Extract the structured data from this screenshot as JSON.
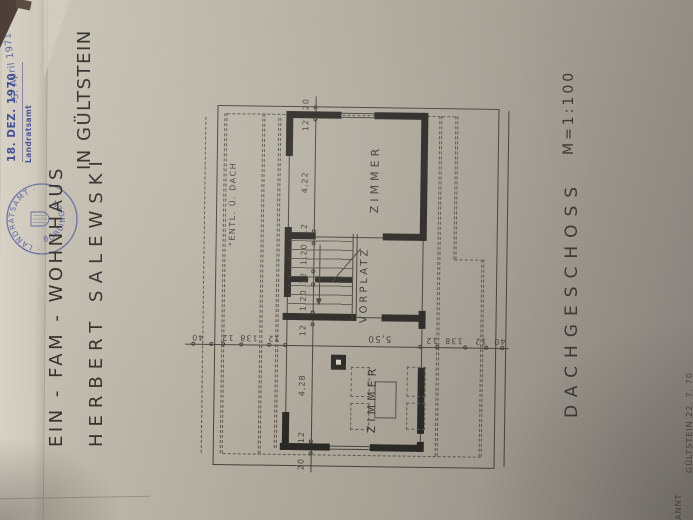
{
  "stamps": {
    "received_date": "18. DEZ. 1970",
    "received_office": "Landratsamt",
    "approval_date": "-5. April 1971",
    "seal_top": "· LANDRATSAMT ·",
    "seal_bottom": "BÖBLINGEN"
  },
  "title": {
    "line1": "EIN - FAM - WOHNHAUS",
    "line1b": "IN GÜLTSTEIN",
    "line2": "HERBERT SALEWSKI"
  },
  "drawing": {
    "name": "DACHGESCHOSS",
    "scale": "M=1:100",
    "rooms": {
      "room_top": "ZIMMER",
      "hall": "VORPLATZ",
      "room_bottom": "ZIMMER",
      "vent": "°ENTL. Ü. DACH",
      "room_width": "5,50"
    },
    "dims_depth": [
      "20",
      "12",
      "4,22",
      "12",
      "1,20",
      "12",
      "1,20",
      "12",
      "4,28",
      "12",
      "20"
    ],
    "dims_width_left": [
      "40",
      "12",
      "138",
      "12"
    ],
    "dims_width_right": [
      "12",
      "138",
      "12",
      "40"
    ]
  },
  "footer": {
    "fragment_left": "KANNT",
    "fragment_right": "GÜLTSTEIN  22. 7. 70"
  },
  "colors": {
    "paper": "#b5afa2",
    "ink": "#45423b",
    "wall": "#2b2925",
    "stamp_blue": "#34428c"
  }
}
